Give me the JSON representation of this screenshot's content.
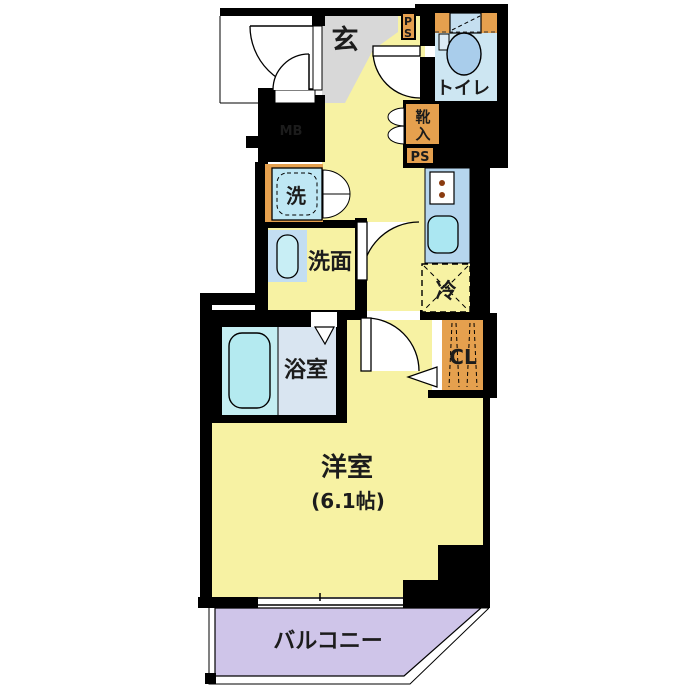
{
  "floorplan": {
    "title": "studio-apartment-floor-plan",
    "labels": {
      "genkan": "玄",
      "toilet": "トイレ",
      "shoe_cabinet_char1": "靴",
      "shoe_cabinet_char2": "入",
      "pipe_space_top_p": "P",
      "pipe_space_top_s": "S",
      "pipe_space_mid": "PS",
      "meter_box": "MB",
      "washer": "洗",
      "washroom": "洗面",
      "fridge": "冷",
      "closet": "CL",
      "bathroom": "浴室",
      "main_room": "洋室",
      "main_room_size": "(6.1帖)",
      "balcony": "バルコニー"
    },
    "colors": {
      "wall": "#000000",
      "floor_yellow": "#f7f2a3",
      "genkan_gray": "#d8d8d8",
      "water_blue": "#cde6f2",
      "kitchen_blue": "#b6d6ee",
      "balcony_purple": "#cfc5e9",
      "cabinet_orange": "#e5a04e"
    }
  }
}
